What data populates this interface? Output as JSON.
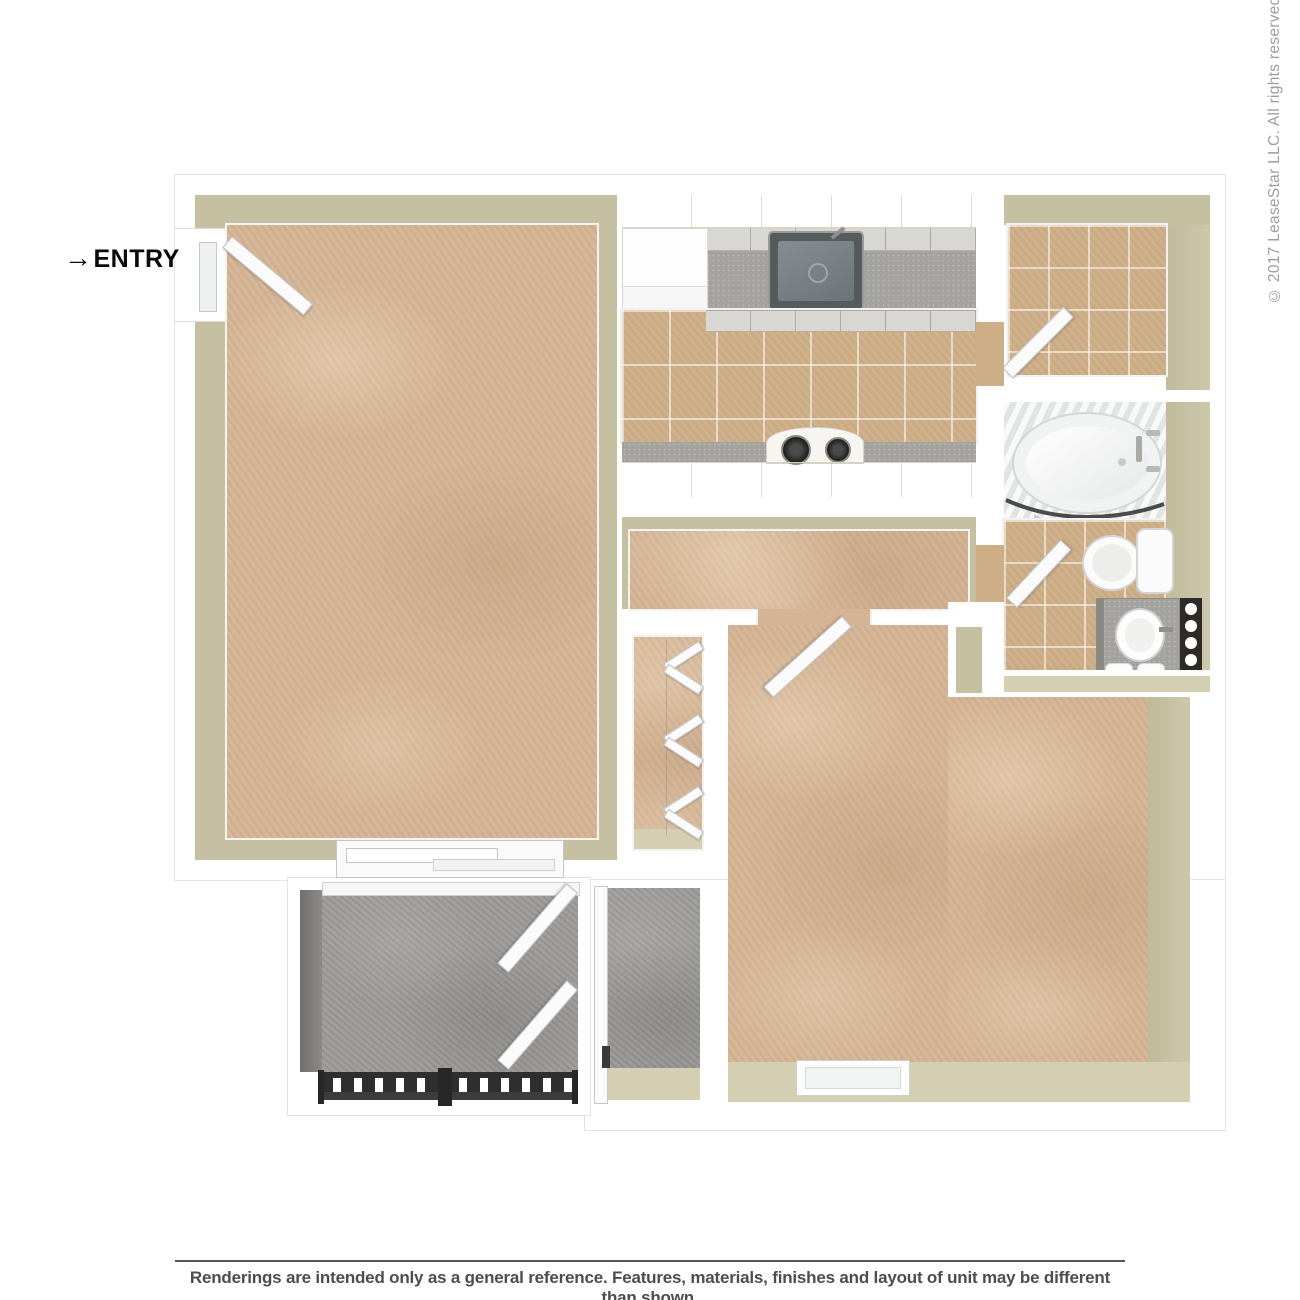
{
  "annotations": {
    "entry_arrow": "→",
    "entry_label": "ENTRY",
    "copyright": "© 2017 LeaseStar LLC. All rights reserved.",
    "disclaimer": "Renderings are intended only as a general reference. Features, materials, finishes and layout of unit may be different than shown."
  },
  "theme": {
    "carpet": "#d4b494",
    "tile": "#cdae87",
    "wall_face": "#c6c0a3",
    "wall_face_light": "#d4ceb3",
    "cabinet_cream": "#f3efe2",
    "cabinet_front": "#d8d7d2",
    "counter": "#a3a29e",
    "appliance_white": "#fdfdfd",
    "sink_dark": "#565b5e",
    "concrete": "#9b9a98",
    "concrete_shadow": "#6f6f6e",
    "railing": "#2e2e2e",
    "fixture_white": "#fbfbfb",
    "text_dark": "#0a0a0a",
    "text_gray": "#9d9d9d",
    "disclaimer": "#4d4d4d",
    "line": "#555555"
  }
}
